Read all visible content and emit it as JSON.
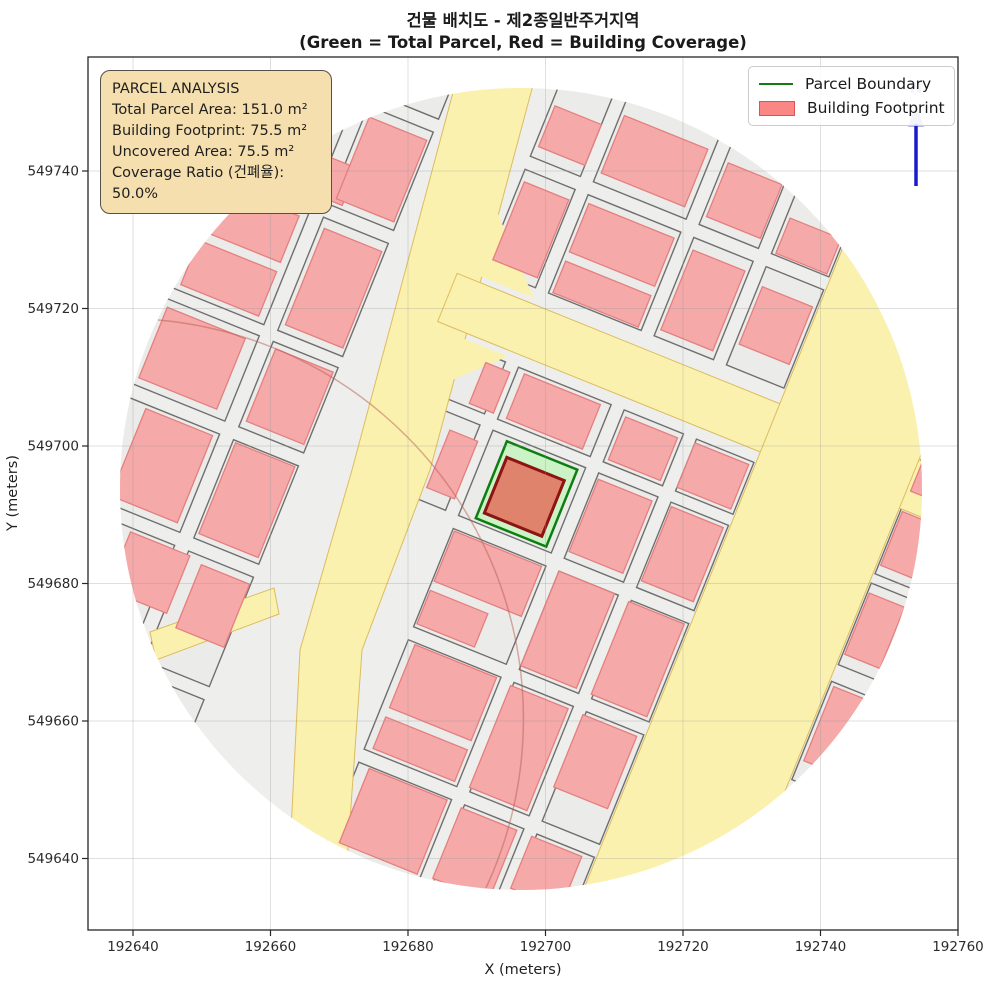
{
  "title": {
    "line1": "건물 배치도 - 제2종일반주거지역",
    "line2": "(Green = Total Parcel, Red = Building Coverage)"
  },
  "axes": {
    "x_label": "X (meters)",
    "y_label": "Y (meters)",
    "x_ticks": [
      192640,
      192660,
      192680,
      192700,
      192720,
      192740,
      192760
    ],
    "y_ticks": [
      549640,
      549660,
      549680,
      549700,
      549720,
      549740
    ]
  },
  "info_box": {
    "title": "PARCEL ANALYSIS",
    "lines": [
      "Total Parcel Area: 151.0 m²",
      "Building Footprint: 75.5 m²",
      "Uncovered Area: 75.5 m²",
      "Coverage Ratio (건폐율): 50.0%"
    ]
  },
  "legend": {
    "items": [
      {
        "label": "Parcel Boundary",
        "type": "line",
        "color": "#157a15"
      },
      {
        "label": "Building Footprint",
        "type": "patch",
        "fill": "#fa8686",
        "edge": "#e05252"
      }
    ]
  },
  "north_arrow": {
    "label": "N",
    "line_color": "#1a1acd",
    "head_color": "#a5a5e0"
  },
  "chart_data": {
    "type": "map",
    "title": "건물 배치도 - 제2종일반주거지역",
    "subtitle": "(Green = Total Parcel, Red = Building Coverage)",
    "xlabel": "X (meters)",
    "ylabel": "Y (meters)",
    "x_range": [
      192633.5,
      192760.5
    ],
    "y_range": [
      549629.5,
      549756.5
    ],
    "grid": true,
    "clip_circle": {
      "center_x": 192696.5,
      "center_y": 549693.5,
      "radius_m": 58.5
    },
    "zoning": "제2종일반주거지역",
    "parcel_analysis": {
      "total_parcel_area_m2": 151.0,
      "building_footprint_m2": 75.5,
      "uncovered_area_m2": 75.5,
      "coverage_ratio_pct": 50.0
    },
    "map": {
      "center_px": [
        521,
        489
      ],
      "clip_radius_px": 401,
      "rotation_deg": 22,
      "colors": {
        "base": "#eeeeec",
        "block_fill": "#ebebe9",
        "block_stroke": "#6f6f6f",
        "road_fill": "#fbf1ae",
        "road_stroke": "#ddbc5e",
        "building_fill": "#f5a9a9",
        "building_stroke": "#e57f7f",
        "parcel_green_fill": "#cbf3c6",
        "parcel_green_stroke": "#0e7d12",
        "central_building_fill": "#e0836c",
        "central_building_stroke": "#8e1414",
        "grid_line": "#999999"
      },
      "blocks_local": [
        [
          -402,
          -298,
          102,
          106
        ],
        [
          -402,
          -178,
          102,
          122
        ],
        [
          -402,
          -44,
          102,
          92
        ],
        [
          -402,
          62,
          102,
          106
        ],
        [
          -402,
          182,
          102,
          118
        ],
        [
          -285,
          -402,
          70,
          90
        ],
        [
          -285,
          -298,
          70,
          106
        ],
        [
          -285,
          -178,
          70,
          122
        ],
        [
          -285,
          -44,
          70,
          92
        ],
        [
          -285,
          62,
          70,
          106
        ],
        [
          -285,
          182,
          70,
          118
        ],
        [
          -285,
          314,
          70,
          88
        ],
        [
          -116,
          -402,
          54,
          90
        ],
        [
          -116,
          -298,
          54,
          106
        ],
        [
          -116,
          -112,
          54,
          56
        ],
        [
          -116,
          -44,
          54,
          92
        ],
        [
          -48,
          -402,
          100,
          90
        ],
        [
          -48,
          -298,
          100,
          106
        ],
        [
          -48,
          -112,
          100,
          56
        ],
        [
          -48,
          -44,
          100,
          92
        ],
        [
          -48,
          62,
          100,
          106
        ],
        [
          -48,
          182,
          100,
          118
        ],
        [
          -48,
          314,
          100,
          88
        ],
        [
          66,
          -402,
          64,
          90
        ],
        [
          66,
          -298,
          64,
          106
        ],
        [
          66,
          -112,
          64,
          56
        ],
        [
          66,
          -44,
          64,
          92
        ],
        [
          66,
          62,
          64,
          106
        ],
        [
          66,
          182,
          64,
          118
        ],
        [
          66,
          314,
          64,
          88
        ],
        [
          144,
          -402,
          62,
          90
        ],
        [
          144,
          -298,
          62,
          106
        ],
        [
          144,
          -112,
          62,
          56
        ],
        [
          144,
          -44,
          62,
          92
        ],
        [
          144,
          62,
          62,
          106
        ],
        [
          144,
          182,
          62,
          118
        ],
        [
          144,
          314,
          62,
          88
        ],
        [
          360,
          -215,
          42,
          82
        ],
        [
          360,
          -126,
          42,
          72
        ],
        [
          360,
          -44,
          42,
          88
        ],
        [
          360,
          62,
          42,
          106
        ],
        [
          360,
          182,
          42,
          76
        ]
      ],
      "buildings_local": [
        [
          -112,
          -368,
          50,
          44
        ],
        [
          -44,
          -385,
          90,
          62
        ],
        [
          70,
          -380,
          58,
          58
        ],
        [
          148,
          -352,
          55,
          38
        ],
        [
          -320,
          -236,
          48,
          40
        ],
        [
          -280,
          -288,
          62,
          88
        ],
        [
          -112,
          -286,
          48,
          84
        ],
        [
          -44,
          -290,
          92,
          52
        ],
        [
          -44,
          -228,
          92,
          34
        ],
        [
          70,
          -286,
          56,
          86
        ],
        [
          148,
          -278,
          54,
          62
        ],
        [
          -392,
          -170,
          84,
          50
        ],
        [
          -392,
          -110,
          84,
          48
        ],
        [
          -280,
          -168,
          62,
          104
        ],
        [
          -80,
          -104,
          26,
          44
        ],
        [
          -40,
          -108,
          82,
          48
        ],
        [
          70,
          -106,
          56,
          46
        ],
        [
          144,
          -108,
          58,
          48
        ],
        [
          -396,
          -36,
          84,
          76
        ],
        [
          -280,
          -38,
          62,
          78
        ],
        [
          -88,
          -28,
          30,
          62
        ],
        [
          68,
          -38,
          58,
          78
        ],
        [
          146,
          -40,
          56,
          80
        ],
        [
          -378,
          66,
          72,
          94
        ],
        [
          -282,
          64,
          64,
          98
        ],
        [
          -46,
          64,
          94,
          54
        ],
        [
          -46,
          128,
          62,
          36
        ],
        [
          66,
          62,
          60,
          102
        ],
        [
          142,
          64,
          60,
          100
        ],
        [
          -346,
          186,
          64,
          62
        ],
        [
          -268,
          190,
          52,
          68
        ],
        [
          -40,
          184,
          88,
          68
        ],
        [
          -40,
          262,
          88,
          34
        ],
        [
          64,
          186,
          62,
          110
        ],
        [
          142,
          186,
          58,
          78
        ],
        [
          -36,
          316,
          84,
          80
        ],
        [
          64,
          318,
          60,
          76
        ],
        [
          140,
          318,
          54,
          56
        ],
        [
          362,
          -206,
          38,
          62
        ],
        [
          362,
          -122,
          38,
          58
        ],
        [
          362,
          -34,
          38,
          66
        ],
        [
          364,
          66,
          36,
          80
        ],
        [
          360,
          186,
          34,
          56
        ]
      ],
      "roads": {
        "main_screen_poly": [
          [
            455,
            85
          ],
          [
            533,
            85
          ],
          [
            430,
            470
          ],
          [
            362,
            650
          ],
          [
            345,
            891
          ],
          [
            288,
            891
          ],
          [
            300,
            650
          ],
          [
            352,
            470
          ]
        ],
        "horizontal_local_rect": [
          -140,
          -176,
          542,
          52
        ],
        "right_local_rect": [
          208,
          -402,
          150,
          806
        ],
        "junction_chamfers_local": [
          [
            [
              -130,
              -50
            ],
            [
              -130,
              -118
            ],
            [
              -62,
              -118
            ]
          ],
          [
            [
              -130,
              -182
            ],
            [
              -60,
              -182
            ],
            [
              -130,
              -252
            ]
          ]
        ],
        "branch_screen_poly": [
          [
            150,
            632
          ],
          [
            274,
            588
          ],
          [
            279,
            614
          ],
          [
            156,
            660
          ]
        ]
      },
      "green_parcel_local": [
        -31,
        -39,
        76,
        83
      ],
      "central_building_local": [
        -25,
        -24,
        62,
        60
      ]
    }
  }
}
